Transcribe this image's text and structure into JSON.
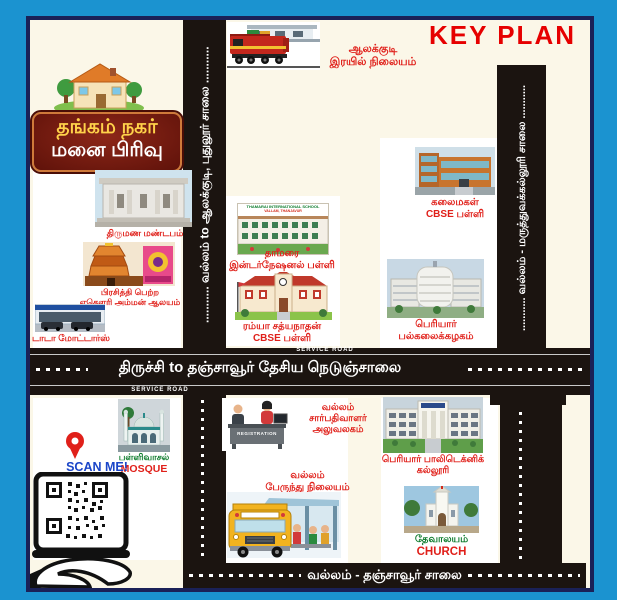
{
  "title": {
    "key_plan": "KEY PLAN"
  },
  "logo": {
    "line1": "தங்கம் நகர்",
    "line2": "மனை பிரிவு"
  },
  "roads": {
    "left_vertical_label": "........... வல்லம் to ஆலக்குடி, புதுலூர் சாலை ...........",
    "right_vertical_label": "........... வல்லம் - மருத்துவக்கல்லூரி சாலை ...........",
    "highway_label": "திருச்சி  to  தஞ்சாவூர் தேசிய நெடுஞ்சாலை",
    "bottom_label": "வல்லம் - தஞ்சாவூர் சாலை",
    "service_road_top": "SERVICE ROAD",
    "service_road_bottom": "SERVICE ROAD"
  },
  "landmarks": {
    "railway_station": {
      "line1": "ஆலக்குடி",
      "line2": "இரயில் நிலையம்"
    },
    "wedding_hall": {
      "line1": "திருமண மண்டபம்"
    },
    "temple": {
      "line1": "பிரசித்தி பெற்ற",
      "line2": "ஏகௌரி அம்மன் ஆலயம்"
    },
    "tata_motors": {
      "line1": "டாடா மோட்டார்ஸ்"
    },
    "thamarai_school": {
      "banner_line1": "THAMARAI INTERNATIONAL SCHOOL",
      "banner_line2": "VALLAM, THANJAVUR",
      "line1": "தாமரை",
      "line2": "இன்டர்நேஷனல் பள்ளி"
    },
    "ramya_school": {
      "line1": "ரம்யா சத்யநாதன்",
      "line2": "CBSE பள்ளி"
    },
    "kalaimagal_school": {
      "line1": "கலைமகள்",
      "line2": "CBSE பள்ளி"
    },
    "periyar_university": {
      "line1": "பெரியார்",
      "line2": "பல்கலைக்கழகம்"
    },
    "registrar_office": {
      "desk_sign": "REGISTRATION",
      "line1": "வல்லம்",
      "line2": "சார்பதிவாளர்",
      "line3": "அலுவலகம்"
    },
    "bus_station": {
      "line1": "வல்லம்",
      "line2": "பேருந்து நிலையம்"
    },
    "polytechnic": {
      "line1": "பெரியார் பாலிடெக்னிக்",
      "line2": "கல்லூரி"
    },
    "church": {
      "line1": "தேவாலயம்",
      "line2": "CHURCH"
    },
    "mosque": {
      "line1": "பள்ளிவாசல்",
      "line2": "MOSQUE"
    }
  },
  "qr": {
    "scan_label": "SCAN ME!"
  },
  "colors": {
    "frame_blue": "#1b93d0",
    "border_navy": "#1a2158",
    "background_cream": "#fbf7e8",
    "road_black": "#1b1410",
    "label_red": "#e0201a",
    "label_green": "#0a7a2a",
    "scan_blue": "#1b46c8",
    "logo_maroon": "#7a1d10",
    "logo_yellow": "#ffd24a",
    "key_plan_red": "#e60000"
  }
}
